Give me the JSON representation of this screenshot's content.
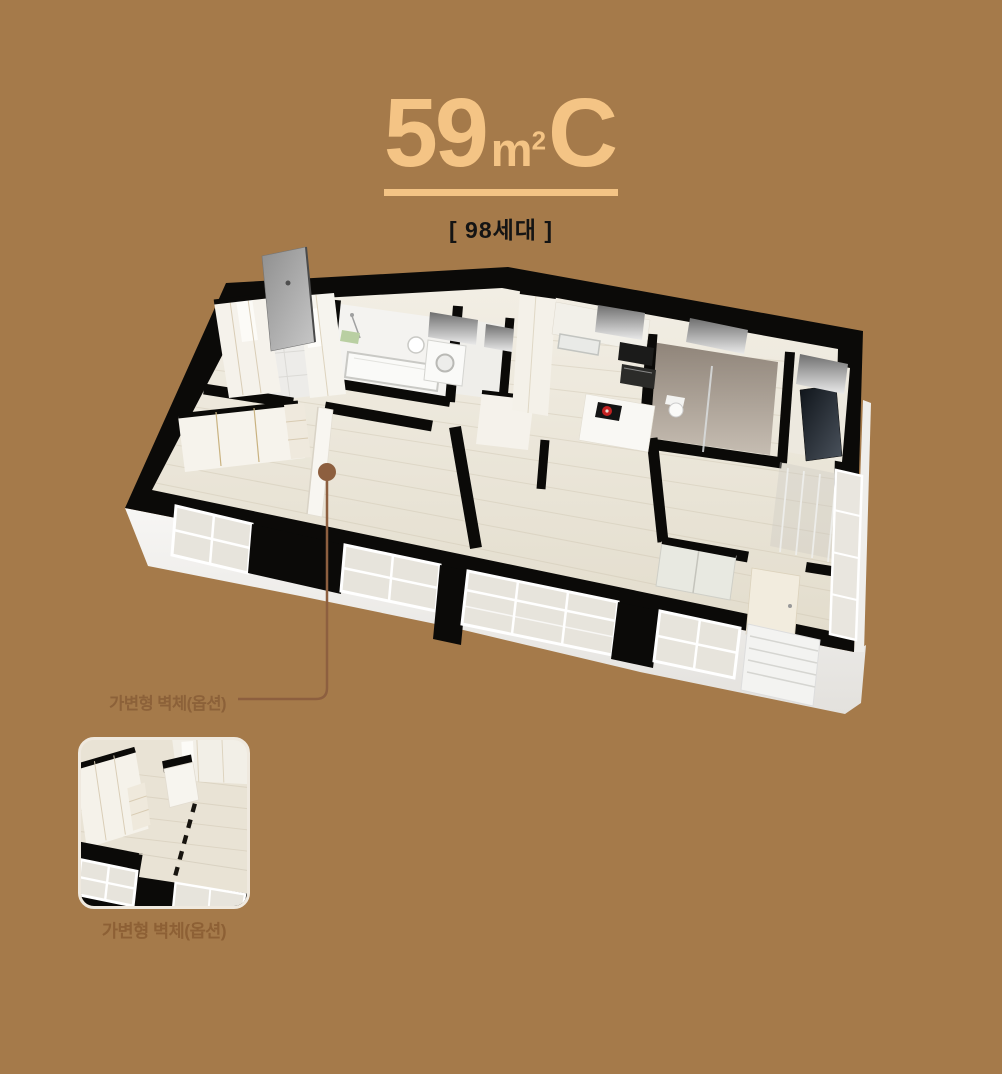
{
  "page": {
    "background_color": "#A57A4A"
  },
  "header": {
    "area_value": "59",
    "area_unit": "m",
    "area_unit_exponent": "2",
    "plan_type": "C",
    "units_count_label": "[ 98세대 ]",
    "accent_color": "#F4C485"
  },
  "floor_plan": {
    "callout": {
      "label": "가변형 벽체(옵션)",
      "line_color": "#8D5F3F"
    },
    "wall_color": "#0B0A08",
    "floor_color": "#EDE8DC"
  },
  "inset": {
    "caption": "가변형 벽체(옵션)"
  }
}
